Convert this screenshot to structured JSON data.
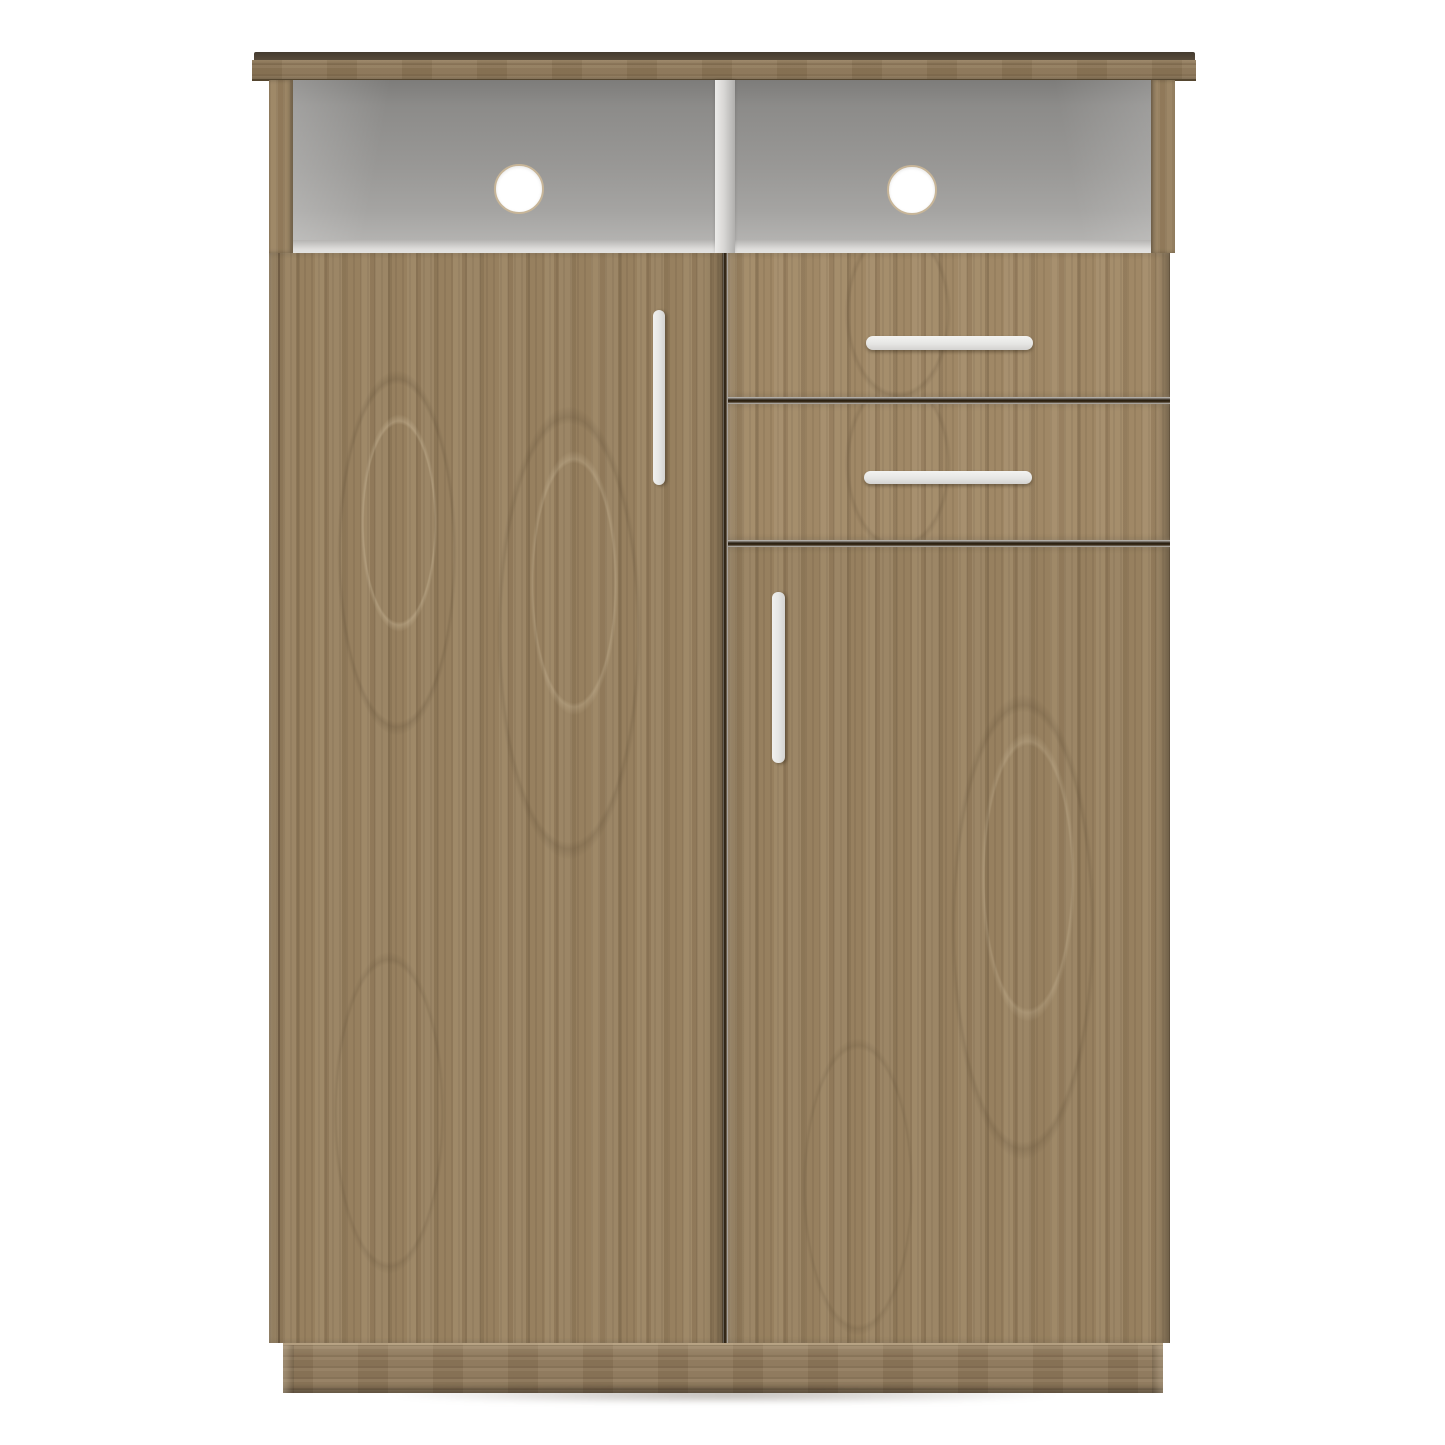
{
  "window": {
    "width": 1445,
    "height": 1445,
    "background": "#ffffff"
  },
  "product_image": {
    "subject": "freestanding wooden storage cabinet, front view product render",
    "finish": "aged oak woodgrain with white interior and aluminum-style bar handles",
    "parts": {
      "top_panel": "overhanging wood top board",
      "open_shelves": [
        {
          "name": "left open compartment",
          "feature": "round cable hole"
        },
        {
          "name": "right open compartment",
          "feature": "round cable hole"
        }
      ],
      "shelf_divider": "white center divider",
      "left_door": "full-height door with vertical bar handle",
      "drawers": [
        {
          "name": "upper drawer",
          "handle": "horizontal bar"
        },
        {
          "name": "lower drawer",
          "handle": "horizontal bar"
        }
      ],
      "right_door": "lower door with vertical bar handle",
      "base": "plinth base with horizontal grain"
    },
    "counts": {
      "doors": 2,
      "drawers": 2,
      "open_shelves": 2,
      "cable_holes": 2
    }
  },
  "colors": {
    "bg": "#ffffff",
    "wood": "#97805f",
    "wood-drawer": "#a08866",
    "wood-top": "#8a7455",
    "wood-base": "#8b7658",
    "top-edge": "#4e4435",
    "interior-top": "#7d7c7a",
    "interior-mid": "#999896",
    "interior-low": "#b3b2b0",
    "lip-light": "#dedddb",
    "divider": "#d8d7d5",
    "handle": "#e6e6e4",
    "gap": "#281e10",
    "hole-rim": "#c7b598"
  }
}
